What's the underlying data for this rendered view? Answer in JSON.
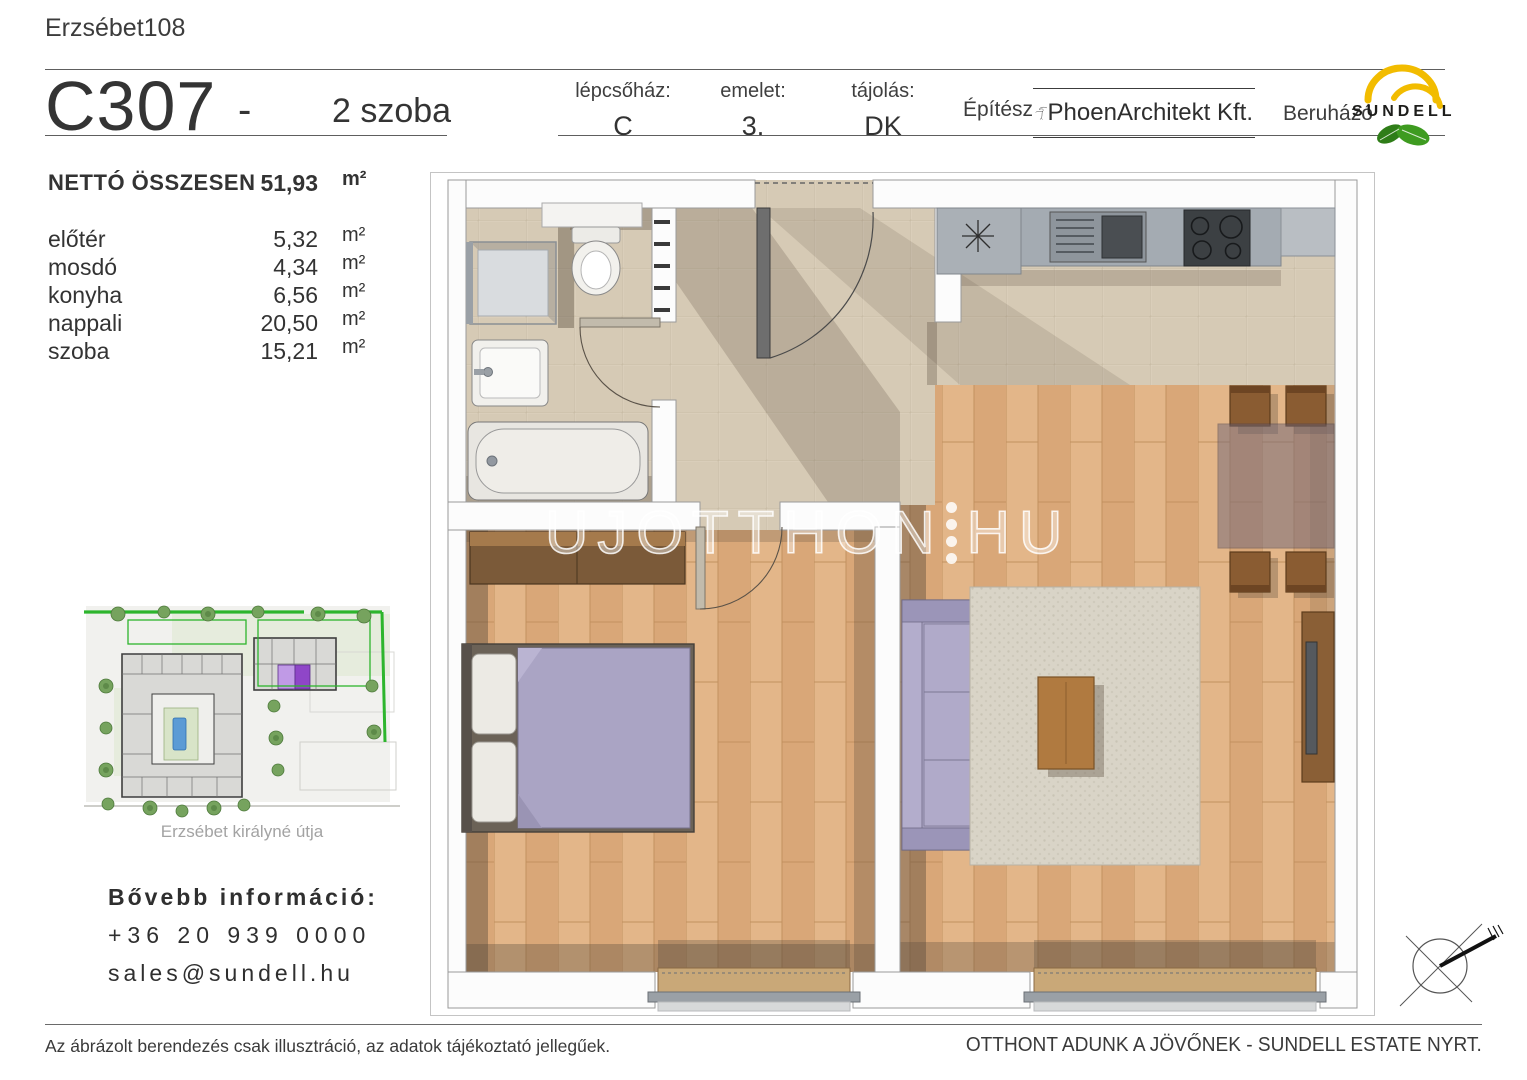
{
  "page": {
    "project": "Erzsébet108",
    "disclaimer": "Az ábrázolt berendezés csak illusztráció, az adatok tájékoztató jellegűek.",
    "footer_right": "OTTHONT ADUNK A JÖVŐNEK - SUNDELL ESTATE NYRT."
  },
  "unit": {
    "code": "C307",
    "separator": "-",
    "rooms_label": "2 szoba"
  },
  "header": {
    "staircase_label": "lépcsőház:",
    "staircase_value": "C",
    "floor_label": "emelet:",
    "floor_value": "3.",
    "orientation_label": "tájolás:",
    "orientation_value": "DK",
    "architect_label": "Építész",
    "architect_name": "PhoenArchitekt Kft.",
    "developer_label": "Beruházó",
    "developer_name": "SUNDELL"
  },
  "areas": {
    "total_label": "NETTÓ ÖSSZESEN",
    "total_value": "51,93",
    "unit": "m²",
    "rooms": [
      {
        "name": "előtér",
        "value": "5,32",
        "unit": "m²"
      },
      {
        "name": "mosdó",
        "value": "4,34",
        "unit": "m²"
      },
      {
        "name": "konyha",
        "value": "6,56",
        "unit": "m²"
      },
      {
        "name": "nappali",
        "value": "20,50",
        "unit": "m²"
      },
      {
        "name": "szoba",
        "value": "15,21",
        "unit": "m²"
      }
    ]
  },
  "sitemap": {
    "street": "Erzsébet királyné útja"
  },
  "contact": {
    "heading": "Bővebb információ:",
    "phone": "+36 20 939 0000",
    "email": "sales@sundell.hu"
  },
  "watermark": {
    "left": "UJOTTHON",
    "right": "HU"
  },
  "icons": {
    "architect_logo": "phoenix-bird",
    "developer_logo": "sun-arcs-with-leaves",
    "compass": "compass-rose"
  },
  "colors": {
    "highlight_purple": "#8f46c8",
    "site_green": "#2db52d",
    "sundell_yellow": "#f2bc00",
    "sundell_green": "#3e9b20",
    "floor_wood": "#deae7e",
    "floor_tile": "#d6cab5",
    "furniture_lavender": "#a9a3c4"
  }
}
